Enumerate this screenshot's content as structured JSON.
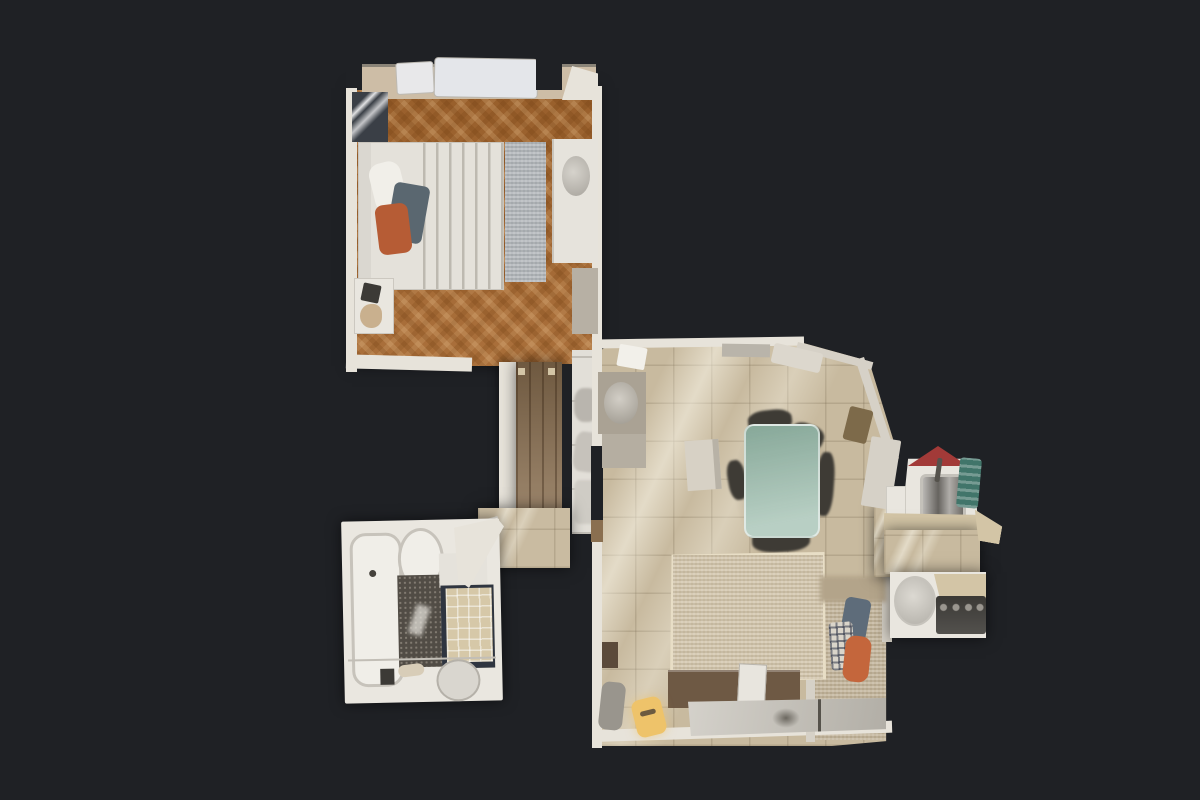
{
  "scene": {
    "view": "top-down-3d-dollhouse-floorplan",
    "rooms": [
      "bedroom",
      "corridor",
      "vestibule",
      "bathroom",
      "living-dining",
      "sleeping-niche",
      "kitchen"
    ],
    "background": "#1f2125",
    "colors": {
      "wall": "#e7e3da",
      "wallDim": "#d6d1c7",
      "sill": "#cdbda6",
      "bedroomFloor": "#a5672f",
      "corridorFloor": "#8a6f50",
      "vestibuleFloor": "#c9bba1",
      "bathWall": "#eae7e0",
      "tub": "#f0eee8",
      "mosaic": "#514c45",
      "showerTile": "#d6c8a8",
      "showerFrame": "#2f3540",
      "washer": "#d9d6cf",
      "livingFloor": "#c8ba9f",
      "nicheFloor": "#bfb095",
      "rug": "#cfc1a6",
      "rugBorder": "#e8dec6",
      "glassTable": "#9dbdad",
      "chairDark": "#3e3b35",
      "floorBox": "#d7d1c5",
      "radiator": "#7d6a4a",
      "sideboard": "#6e5944",
      "console": "#c6c2b9",
      "yellowChair": "#eec36a",
      "smallCabinet": "#5b4a3a",
      "grayChair": "#99958d",
      "pillowSlate": "#5e6c7a",
      "pillowPlaid": "#dad5ca",
      "throwOrange": "#c4663c",
      "duvet": "#e4e1da",
      "pillow": "#f1efe9",
      "blanket": "#5a6770",
      "bedThrow": "#b65c35",
      "headboard": "#dad7d0",
      "bedroomRug": "#aeb2b6",
      "dresser": "#e6e3dc",
      "sideTaupe": "#b7b0a4",
      "artFrame": "#3a3f46",
      "nightstand": "#e9e6df",
      "closet": "#e2dfd8",
      "kitchenCounter": "#e9e6df",
      "steel": "#8e8a84",
      "stove": "#3b3935",
      "hoodRed": "#a23a38",
      "tealTowel": "#41756a",
      "shelf": "#d3c5a6"
    }
  }
}
